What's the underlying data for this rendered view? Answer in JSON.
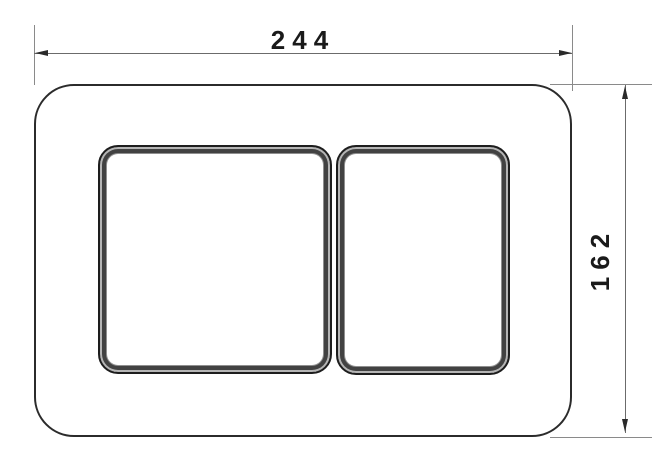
{
  "drawing": {
    "type": "technical-dimension-drawing",
    "subject": "dual-flush toilet actuator plate, front view"
  },
  "dimensions": {
    "width": {
      "label": "244"
    },
    "height": {
      "label": "162"
    }
  },
  "colors": {
    "background": "#ffffff",
    "plate_outline": "#2b2b2b",
    "button_frame_dark": "#424242",
    "button_frame_highlight": "#b5b5b5",
    "dimension_line": "#6b6b6b",
    "extension_line": "#8a8a8a",
    "label_text": "#1a1a1a"
  }
}
